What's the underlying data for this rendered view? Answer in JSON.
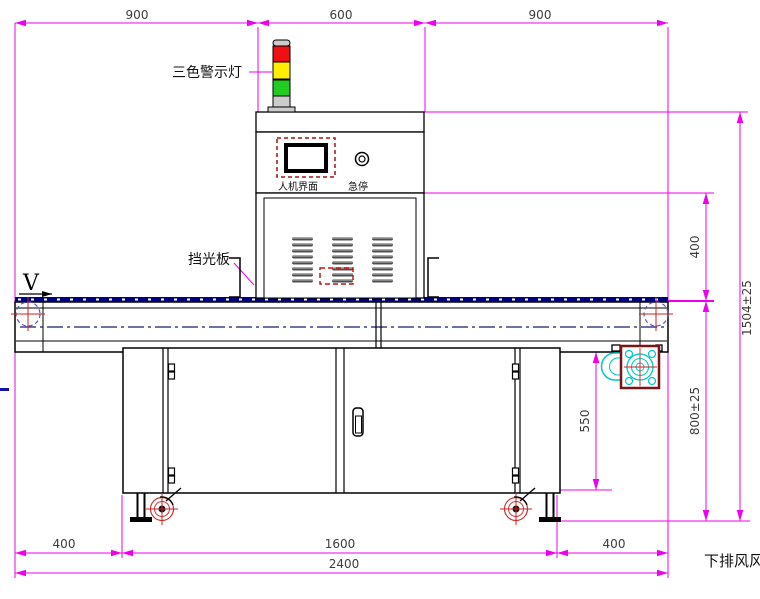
{
  "labels": {
    "warning_light": "三色警示灯",
    "hmi_label": "人机界面",
    "estop_label": "急停",
    "light_shield": "挡光板",
    "belt_direction": "V",
    "bottom_note": "下排风风"
  },
  "dimensions": {
    "top": [
      "900",
      "600",
      "900"
    ],
    "right": {
      "upper": "400",
      "lower": "800±25",
      "overall": "1504±25"
    },
    "side": {
      "cabinet_height": "550"
    },
    "bottom": {
      "left": "400",
      "middle": "1600",
      "right": "400",
      "overall": "2400"
    }
  },
  "colors": {
    "dimension": "#ee00ee",
    "belt": "#000080",
    "warning_red": "#ee1111",
    "warning_yellow": "#ffee00",
    "warning_green": "#22cc22",
    "fan_accent": "#00c8c8",
    "fan_frame": "#7a1515",
    "caster": "#cc3333"
  }
}
